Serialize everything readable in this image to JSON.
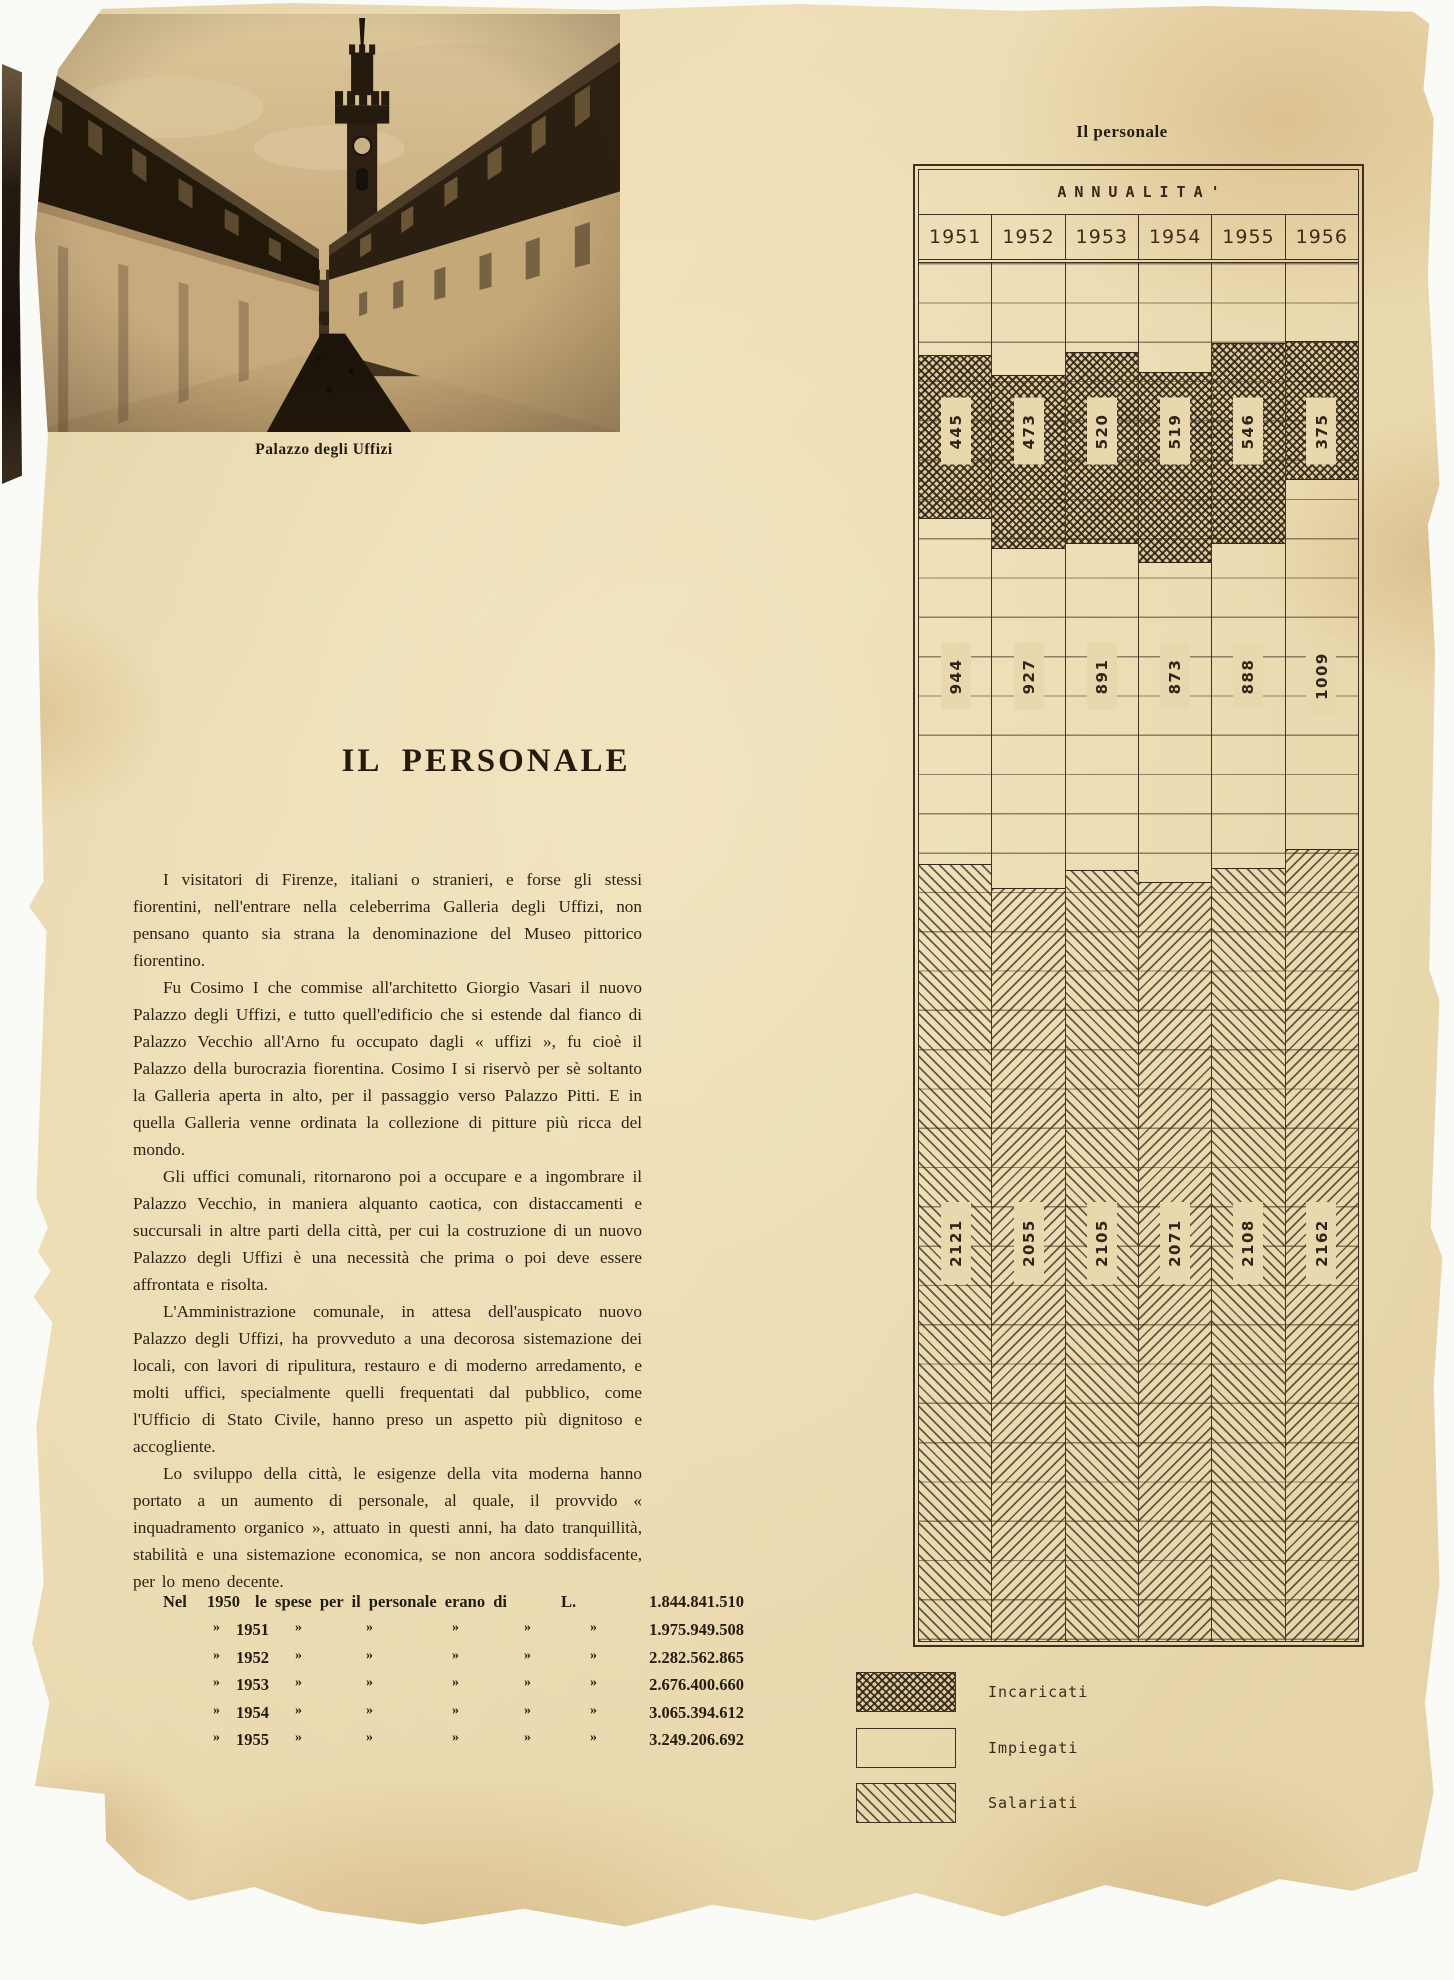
{
  "page_header": {
    "label": "Il personale"
  },
  "photo": {
    "caption": "Palazzo degli Uffizi"
  },
  "article": {
    "title": "IL PERSONALE",
    "paragraphs": [
      "I visitatori di Firenze, italiani o stranieri, e forse gli stessi fiorentini, nell'entrare nella celeberrima Galleria degli Uffizi, non pensano quanto sia strana la denominazione del Museo pittorico fiorentino.",
      "Fu Cosimo I che commise all'architetto Giorgio Vasari il nuovo Palazzo degli Uffizi, e tutto quell'edificio che si estende dal fianco di Palazzo Vecchio all'Arno fu occupato dagli « uffizi », fu cioè il Palazzo della burocrazia fiorentina. Cosimo I si riservò per sè soltanto la Galleria aperta in alto, per il passaggio verso Palazzo Pitti. E in quella Galleria venne ordinata la collezione di pitture più ricca del mondo.",
      "Gli uffici comunali, ritornarono poi a occupare e a ingombrare il Palazzo Vecchio, in maniera alquanto caotica, con distaccamenti e succursali in altre parti della città, per cui la costruzione di un nuovo Palazzo degli Uffizi è una necessità che prima o poi deve essere affrontata e risolta.",
      "L'Amministrazione comunale, in attesa dell'auspicato nuovo Palazzo degli Uffizi, ha provveduto a una decorosa sistemazione dei locali, con lavori di ripulitura, restauro e di moderno arredamento, e molti uffici, specialmente quelli frequentati dal pubblico, come l'Ufficio di Stato Civile, hanno preso un aspetto più dignitoso e accogliente.",
      "Lo sviluppo della città, le esigenze della vita moderna hanno portato a un aumento di personale, al quale, il provvido « inquadramento organico », attuato in questi anni, ha dato tranquillità, stabilità e una sistemazione economica, se non ancora soddisfacente, per lo meno decente."
    ]
  },
  "expense_table": {
    "first_row": {
      "lead": "Nel",
      "year": "1950",
      "phrase": "le spese per il personale erano di",
      "currency": "L.",
      "value": "1.844.841.510"
    },
    "ditto_mark": "»",
    "rows": [
      {
        "year": "1951",
        "value": "1.975.949.508"
      },
      {
        "year": "1952",
        "value": "2.282.562.865"
      },
      {
        "year": "1953",
        "value": "2.676.400.660"
      },
      {
        "year": "1954",
        "value": "3.065.394.612"
      },
      {
        "year": "1955",
        "value": "3.249.206.692"
      }
    ]
  },
  "chart_data": {
    "type": "bar",
    "stacked": true,
    "title": "ANNUALITA'",
    "categories": [
      "1951",
      "1952",
      "1953",
      "1954",
      "1955",
      "1956"
    ],
    "series": [
      {
        "name": "Incaricati",
        "pattern": "crosshatch",
        "values": [
          445,
          473,
          520,
          519,
          546,
          375
        ]
      },
      {
        "name": "Impiegati",
        "pattern": "plain",
        "values": [
          944,
          927,
          891,
          873,
          888,
          1009
        ]
      },
      {
        "name": "Salariati",
        "pattern": "diagonal",
        "values": [
          2121,
          2055,
          2105,
          2071,
          2108,
          2162
        ]
      }
    ],
    "totals": [
      3510,
      3455,
      3516,
      3463,
      3542,
      3546
    ],
    "ylim": [
      0,
      3760
    ],
    "grid": "horizontal",
    "legend_position": "below"
  },
  "legend": {
    "items": [
      {
        "label": "Incaricati",
        "pattern": "crosshatch"
      },
      {
        "label": "Impiegati",
        "pattern": "plain"
      },
      {
        "label": "Salariati",
        "pattern": "diagonal"
      }
    ]
  },
  "colors": {
    "paper": "#e9d7ad",
    "ink": "#2d2315",
    "line": "#3e3120"
  }
}
